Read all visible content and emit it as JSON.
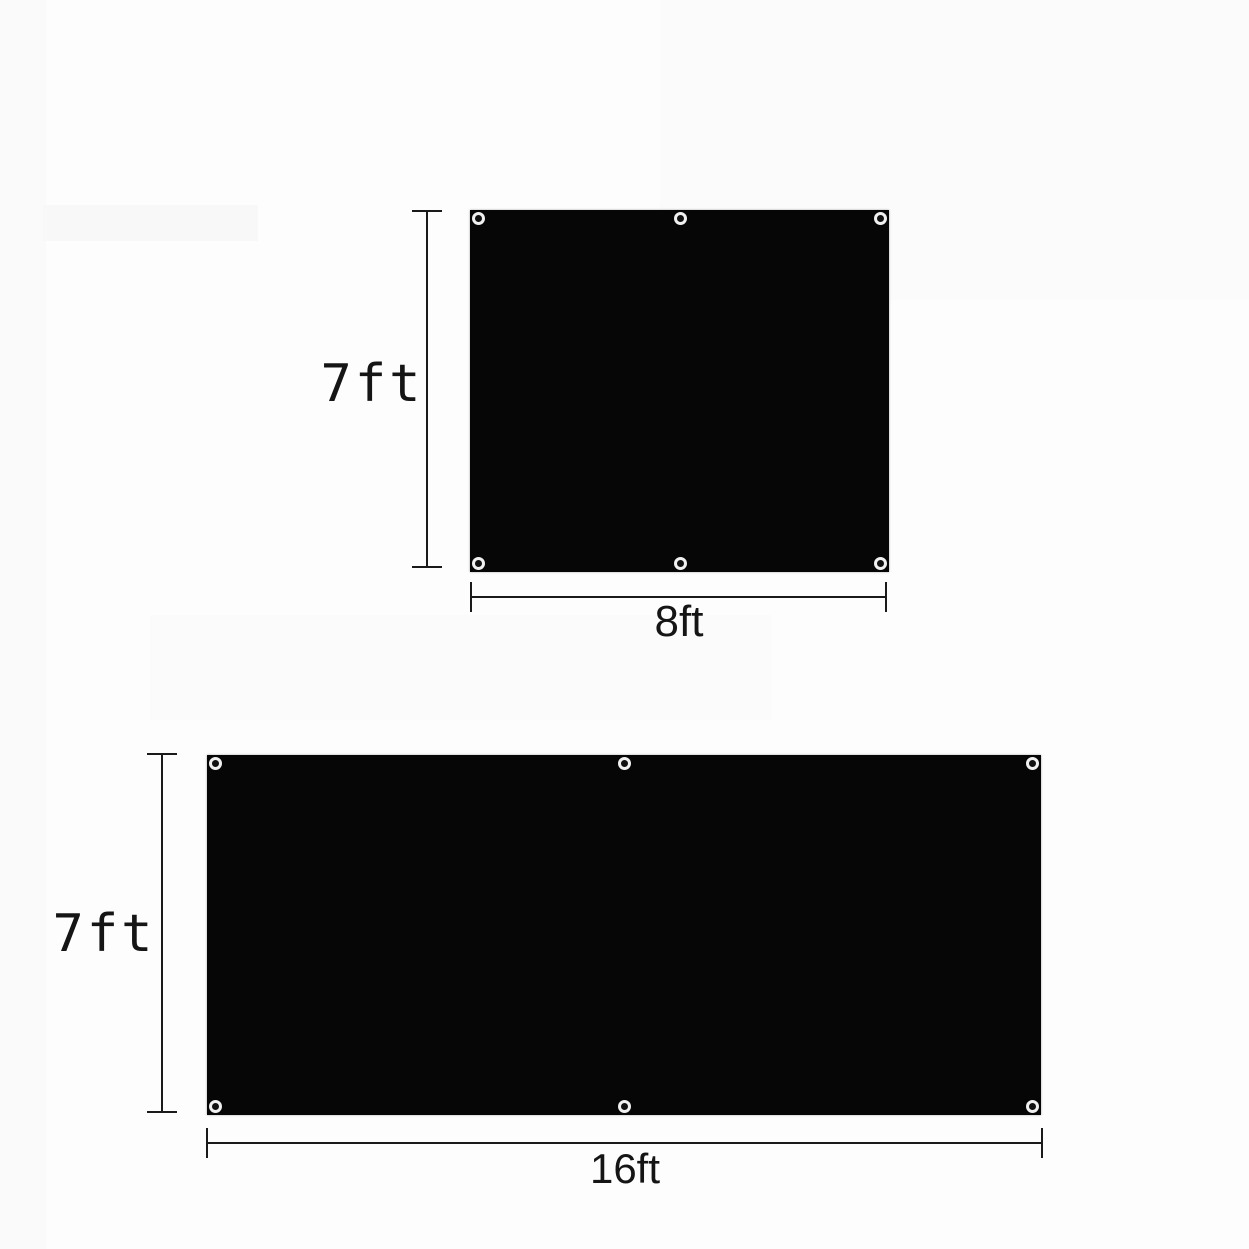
{
  "diagram": {
    "type": "product-size-diagram",
    "description": "Two black panels with corner and midpoint grommets, annotated with dimension lines",
    "panels": [
      {
        "id": "panel-7x8",
        "height_label": "7ft",
        "width_label": "8ft",
        "height_ft": 7,
        "width_ft": 8,
        "grommet_count": 6
      },
      {
        "id": "panel-7x16",
        "height_label": "7ft",
        "width_label": "16ft",
        "height_ft": 7,
        "width_ft": 16,
        "grommet_count": 6
      }
    ],
    "colors": {
      "panel": "#060606",
      "line": "#1a1a1a",
      "grommet": "#f0f0f0",
      "background": "#fdfdfd",
      "text": "#151515"
    }
  }
}
